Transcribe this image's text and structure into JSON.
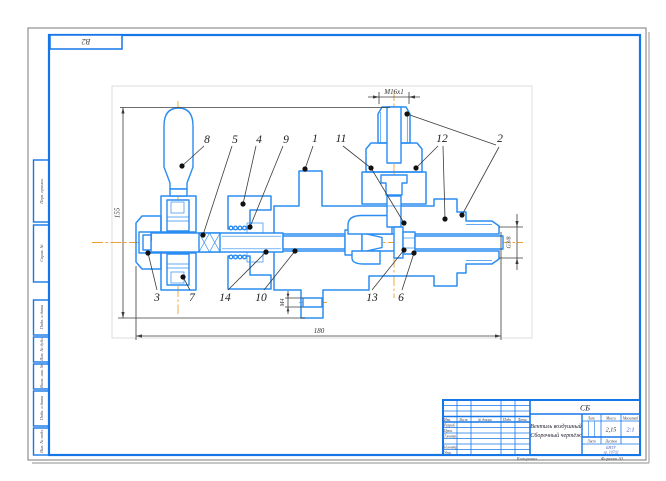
{
  "colors": {
    "frame_blue": "#1576e8",
    "part_blue": "#2b8df2",
    "centerline_orange": "#f0a030",
    "hatch_gray": "#4a4a4a",
    "dim_gray": "#3c3c3c",
    "sheet_border_gray": "#8f8f8f",
    "scale_value_blue": "#2b49d8"
  },
  "corner_box": {
    "label": "В2"
  },
  "side_boxes": [
    {
      "label": "Перв. примен."
    },
    {
      "label": "Справ. №"
    },
    {
      "label": "Подп. и дата"
    },
    {
      "label": "Инв. № дубл."
    },
    {
      "label": "Взам. инв. №"
    },
    {
      "label": "Подп. и дата"
    },
    {
      "label": "Инв. № подл."
    }
  ],
  "drawing": {
    "callouts": [
      {
        "n": "8"
      },
      {
        "n": "5"
      },
      {
        "n": "4"
      },
      {
        "n": "9"
      },
      {
        "n": "1"
      },
      {
        "n": "11"
      },
      {
        "n": "12"
      },
      {
        "n": "2"
      },
      {
        "n": "3"
      },
      {
        "n": "7"
      },
      {
        "n": "14"
      },
      {
        "n": "10"
      },
      {
        "n": "13"
      },
      {
        "n": "6"
      }
    ],
    "dims": {
      "top": "М16х1",
      "left": "155",
      "bottom": "180",
      "right": "G3/8",
      "flange": "М4"
    }
  },
  "title_block": {
    "doc_code": "СБ",
    "name_line1": "Вентиль воздушный",
    "name_line2": "Сборочный чертёж",
    "cols": {
      "izm": "Изм.",
      "list": "Лист",
      "doc": "№ докум.",
      "podp": "Подп.",
      "data": "Дата"
    },
    "rows": [
      {
        "label": "Разраб."
      },
      {
        "label": "Пров."
      },
      {
        "label": "Т.контр."
      },
      {
        "label": "Н.контр."
      },
      {
        "label": "Утв."
      }
    ],
    "lit_label": "Лит.",
    "mass_label": "Масса",
    "scale_label": "Масштаб",
    "mass_value": "2,15",
    "scale_value": "2:1",
    "sheet_label": "Лист",
    "sheets_label": "Листов",
    "org_line1": "БНТУ",
    "org_line2": "гр. 10702",
    "footer_left": "Копировал",
    "footer_right": "Формат A3"
  }
}
